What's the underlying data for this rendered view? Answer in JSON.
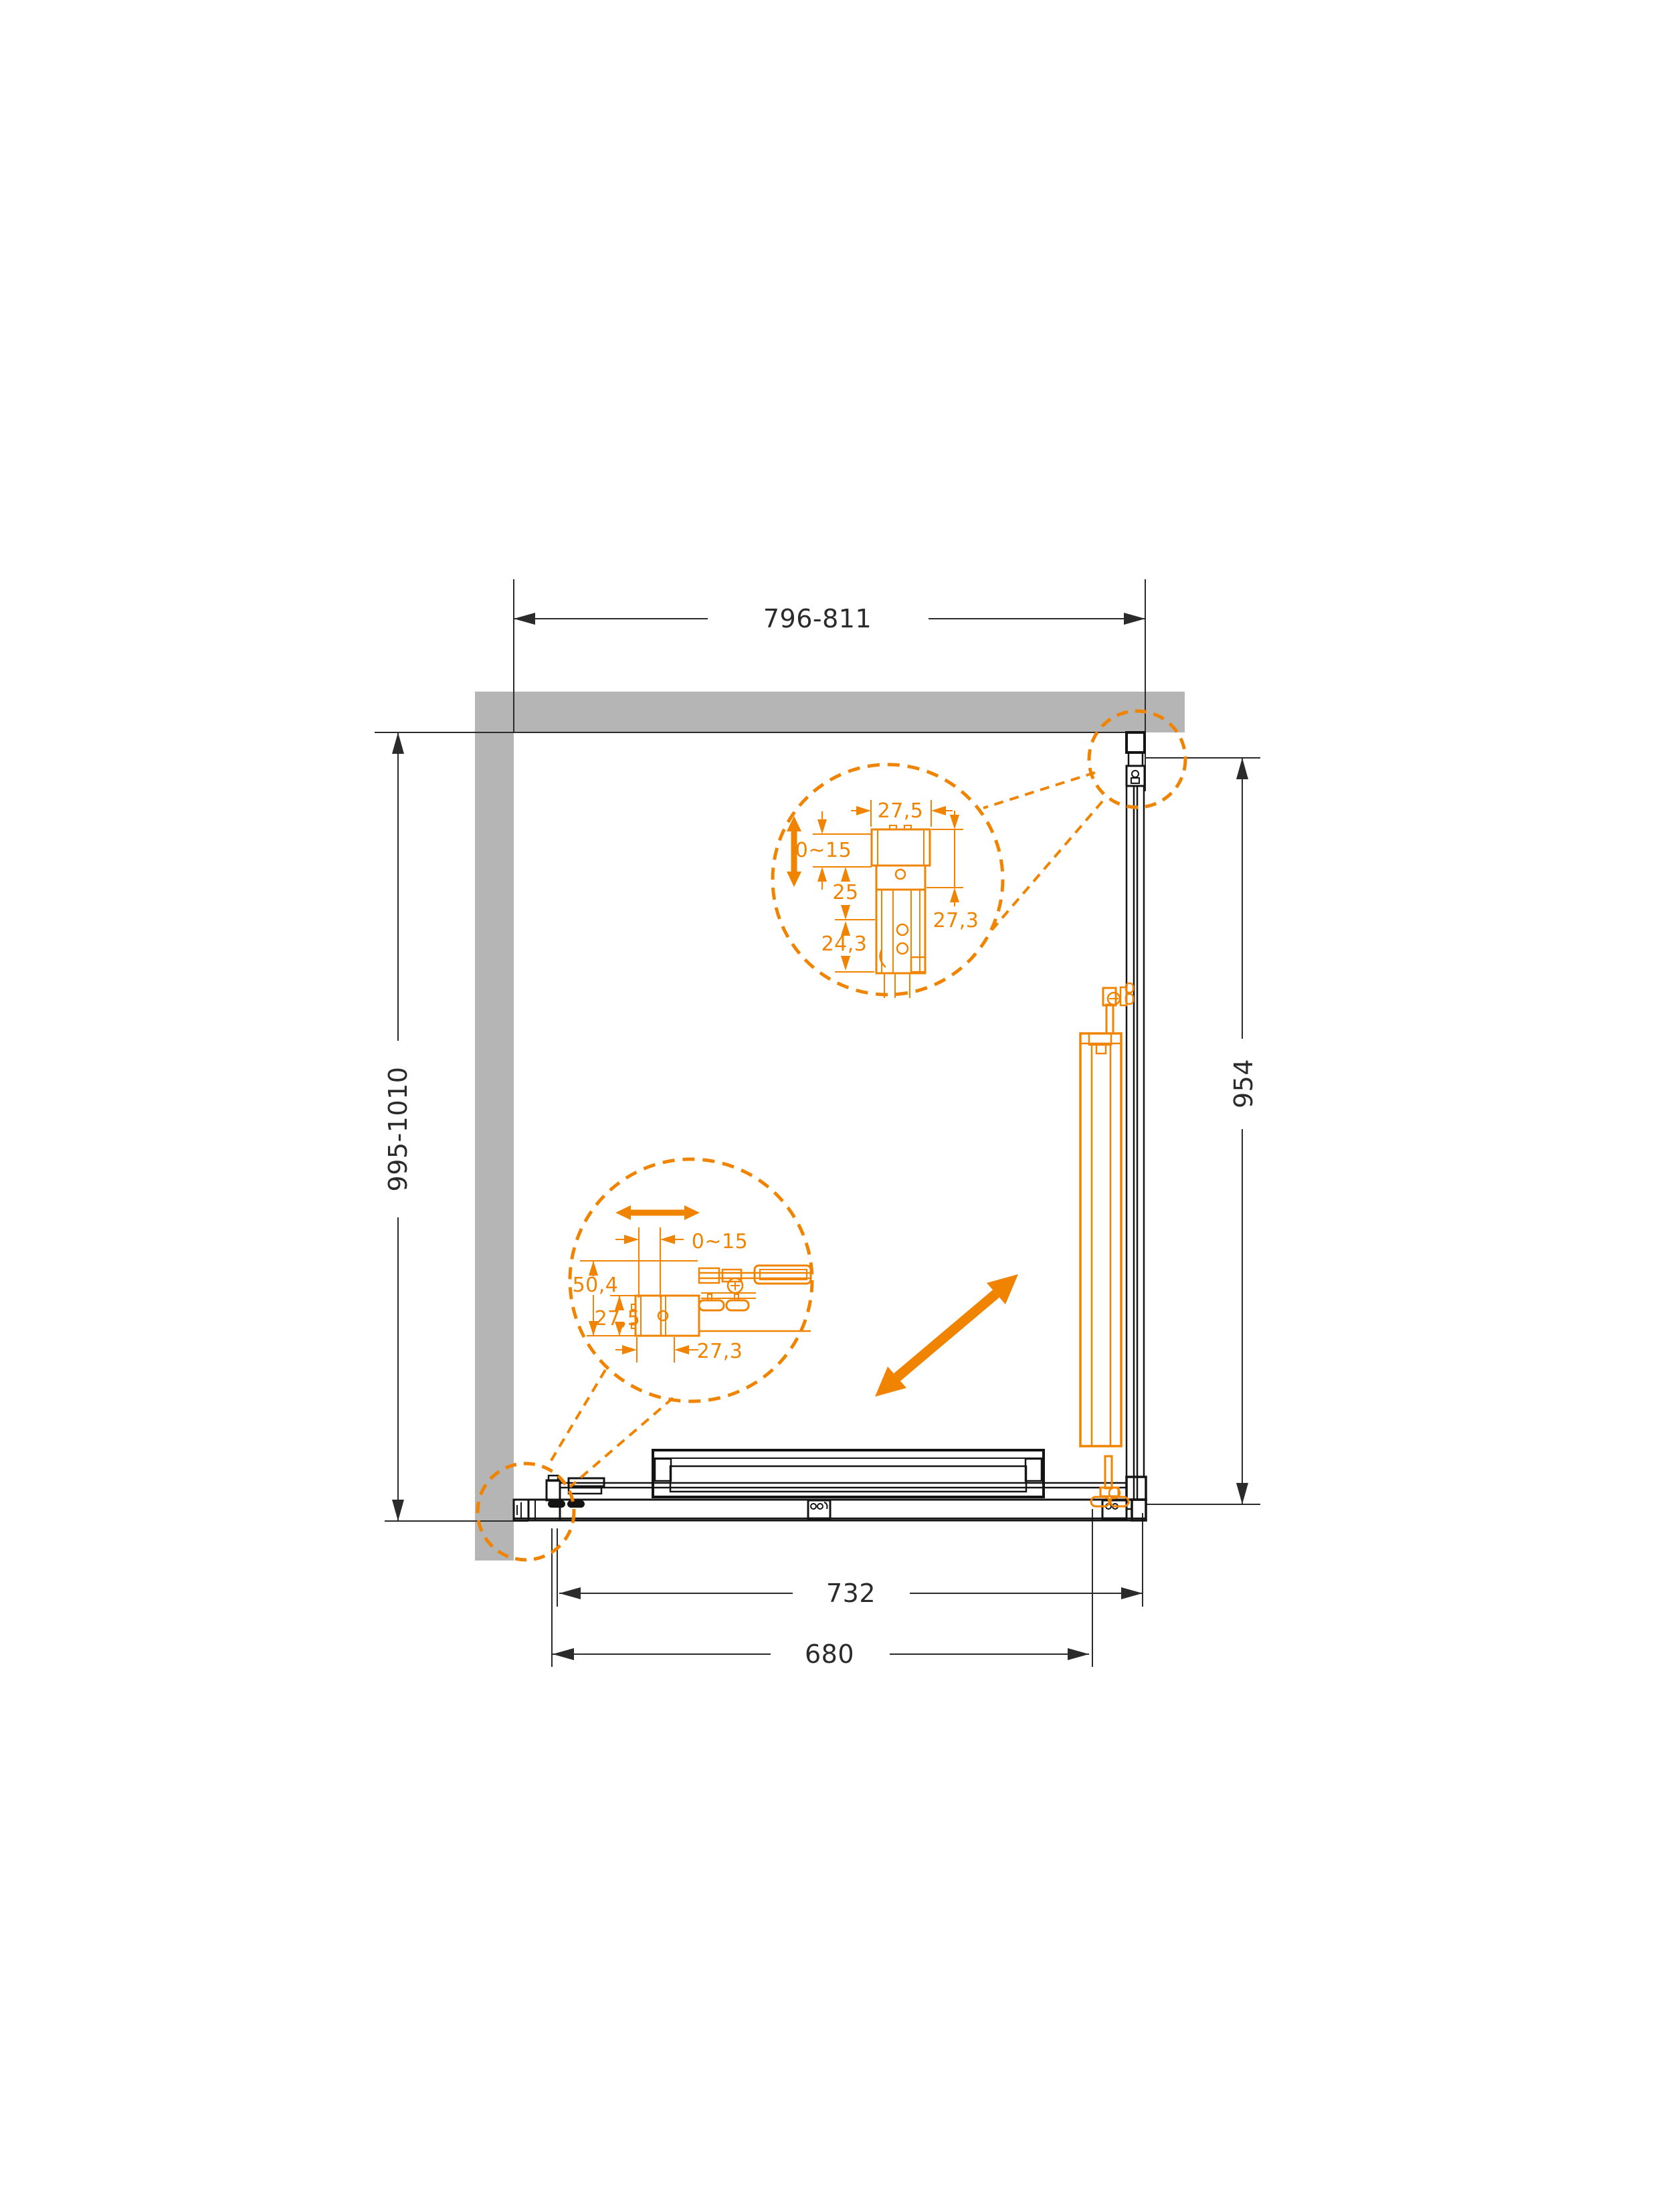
{
  "drawing": {
    "dimensions": {
      "top_width": "796-811",
      "left_height": "995-1010",
      "right_panel": "954",
      "door_width": "732",
      "opening_width": "680"
    },
    "detail_top": {
      "profile_width": "27,5",
      "adjust_range": "0~15",
      "inset": "25",
      "profile_depth": "27,3",
      "rail_depth": "24,3"
    },
    "detail_bottom": {
      "adjust_range": "0~15",
      "total_height": "50,4",
      "profile_height": "27,5",
      "profile_width": "27,3"
    },
    "colors": {
      "accent_orange": "#f08300",
      "wall_gray": "#b5b5b5",
      "line_black": "#2b2b2b"
    }
  }
}
